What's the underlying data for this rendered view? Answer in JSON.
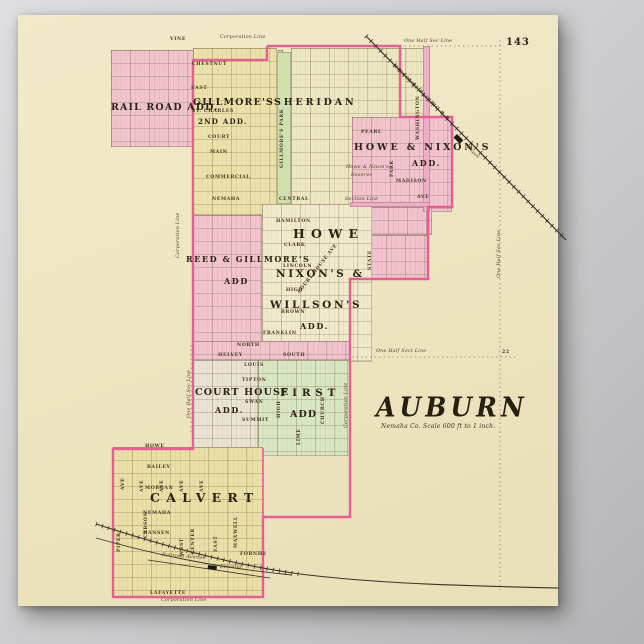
{
  "page": {
    "number": "143",
    "title": "AUBURN",
    "subtitle": "Nemaha Co. Scale 600 ft to 1 inch."
  },
  "palette": {
    "backdrop": "#c7c7c9",
    "paper": "#efe7c6",
    "addition_pink": "#f0c3cd",
    "avenue_pink": "#efaec7",
    "boundary_pink": "#e55f93",
    "addition_yellow": "#ebe2ab",
    "addition_green": "#d9e6c3",
    "park_green": "#cfe0ae",
    "addition_gray": "#e8e3d3",
    "ink": "#3a2f1e"
  },
  "map": {
    "regions": [
      {
        "id": "rail-road-add",
        "x": 111,
        "y": 50,
        "w": 172,
        "h": 97,
        "f": "#f0c3cd",
        "g": true
      },
      {
        "id": "gillmores-second-add",
        "x": 193,
        "y": 48,
        "w": 84,
        "h": 167,
        "f": "#ebe2ab",
        "g": true
      },
      {
        "id": "gillmores-park",
        "x": 277,
        "y": 52,
        "w": 14,
        "h": 152,
        "f": "#cfe0ae",
        "g": false
      },
      {
        "id": "sheridan",
        "x": 291,
        "y": 48,
        "w": 137,
        "h": 159,
        "f": "#ece6c2",
        "g": true
      },
      {
        "id": "howe-nixons-add",
        "x": 352,
        "y": 117,
        "w": 100,
        "h": 95,
        "f": "#f0c3cd",
        "g": true
      },
      {
        "id": "howe-nixons-south",
        "x": 350,
        "y": 207,
        "w": 82,
        "h": 28,
        "f": "#f0c3cd",
        "g": true
      },
      {
        "id": "state-street-blocks",
        "x": 348,
        "y": 235,
        "w": 80,
        "h": 44,
        "f": "#f0c3cd",
        "g": true
      },
      {
        "id": "center-city",
        "x": 262,
        "y": 204,
        "w": 110,
        "h": 158,
        "f": "#f0e9cb",
        "g": true
      },
      {
        "id": "reed-gillmores-add",
        "x": 193,
        "y": 215,
        "w": 69,
        "h": 146,
        "f": "#f0c3cd",
        "g": true
      },
      {
        "id": "north-street-strip",
        "x": 193,
        "y": 341,
        "w": 157,
        "h": 19,
        "f": "#f0c3cd",
        "g": true
      },
      {
        "id": "court-house-add",
        "x": 193,
        "y": 360,
        "w": 65,
        "h": 96,
        "f": "#e8e3d3",
        "g": true
      },
      {
        "id": "first-add",
        "x": 258,
        "y": 360,
        "w": 90,
        "h": 96,
        "f": "#d9e6c3",
        "g": true
      },
      {
        "id": "calvert",
        "x": 113,
        "y": 447,
        "w": 150,
        "h": 150,
        "f": "#eadfa6",
        "g": true
      },
      {
        "id": "washington-ave-stripe",
        "x": 423,
        "y": 46,
        "w": 7,
        "h": 166,
        "f": "#efaec7",
        "g": false
      },
      {
        "id": "ave-stripe",
        "x": 350,
        "y": 202,
        "w": 80,
        "h": 5,
        "f": "#efaec7",
        "g": false
      }
    ],
    "lines": [
      {
        "id": "corporation-boundary",
        "d": "M267,46 L400,46 L400,117 L452,117 L452,207 L428,207 L428,279 L350,279 L350,517 L263,517 L263,597 L113,597 L113,449 L193,449 L193,60 L267,60 L267,46",
        "s": "#e55f93",
        "w": 2.4
      },
      {
        "id": "corporation-edge-calvert",
        "d": "M263,448 L263,517",
        "s": "#e55f93",
        "w": 1.6
      },
      {
        "id": "railroad-missouri-pacific",
        "d": "M366,36 L566,240",
        "s": "#3c3326",
        "w": 1.2
      },
      {
        "id": "railroad-missouri-pacific-ties",
        "d": "M366,36 L566,240",
        "s": "#3c3326",
        "w": 5,
        "dash": "0.8 6"
      },
      {
        "id": "railroad-south-main",
        "d": "M96,524 C170,548 240,566 300,574 C380,584 470,586 558,588",
        "s": "#3c3326",
        "w": 1.1
      },
      {
        "id": "railroad-south-ties",
        "d": "M96,524 C170,548 240,566 300,574",
        "s": "#3c3326",
        "w": 4.5,
        "dash": "0.8 5.5"
      },
      {
        "id": "railroad-south-branch",
        "d": "M96,538 C160,556 220,568 292,575",
        "s": "#3c3326",
        "w": 0.9
      },
      {
        "id": "railroad-siding",
        "d": "M148,560 L270,578",
        "s": "#3c3326",
        "w": 0.8
      },
      {
        "id": "section-line-east",
        "d": "M500,40 L500,590",
        "s": "#8f8266",
        "w": 0.8,
        "dash": "1.5 3"
      },
      {
        "id": "section-line-top",
        "d": "M400,46 L500,46",
        "s": "#8f8266",
        "w": 0.8,
        "dash": "1.5 3"
      },
      {
        "id": "section-line-half",
        "d": "M352,357 L516,357",
        "s": "#8f8266",
        "w": 0.8,
        "dash": "1.5 3"
      },
      {
        "id": "section-line-west",
        "d": "M191,345 L191,434",
        "s": "#8f8266",
        "w": 0.8,
        "dash": "1.5 3"
      }
    ],
    "markers": [
      {
        "id": "depot-marker",
        "x": 457,
        "y": 134,
        "w": 9,
        "h": 5,
        "r": 45
      },
      {
        "id": "elevator-marker",
        "x": 208,
        "y": 565,
        "w": 9,
        "h": 4,
        "r": 6
      }
    ],
    "labels": [
      {
        "t": "One Half Sec Line",
        "x": 404,
        "y": 40,
        "c": "it"
      },
      {
        "t": "Corporation Line",
        "x": 220,
        "y": 36,
        "c": "it"
      },
      {
        "t": "VINE",
        "x": 170,
        "y": 38,
        "c": "st"
      },
      {
        "t": "CHESTNUT",
        "x": 192,
        "y": 63,
        "c": "st"
      },
      {
        "t": "EAST",
        "x": 191,
        "y": 87,
        "c": "st"
      },
      {
        "t": "RAIL ROAD ADD.",
        "x": 111,
        "y": 103,
        "c": "add11"
      },
      {
        "t": "GILLMORE'S",
        "x": 193,
        "y": 98,
        "c": "add11"
      },
      {
        "t": "SHERIDAN",
        "x": 274,
        "y": 98,
        "c": "add11sp"
      },
      {
        "t": "ST. CHARLES",
        "x": 192,
        "y": 110,
        "c": "st"
      },
      {
        "t": "2ND ADD.",
        "x": 198,
        "y": 118,
        "c": "add9"
      },
      {
        "t": "COURT",
        "x": 208,
        "y": 136,
        "c": "st"
      },
      {
        "t": "MAIN",
        "x": 210,
        "y": 151,
        "c": "st"
      },
      {
        "t": "COMMERCIAL",
        "x": 206,
        "y": 176,
        "c": "st"
      },
      {
        "t": "GILLMORE'S PARK",
        "x": 281,
        "y": 168,
        "c": "stv"
      },
      {
        "t": "HOWE & NIXON'S",
        "x": 354,
        "y": 143,
        "c": "add11sp"
      },
      {
        "t": "ADD.",
        "x": 412,
        "y": 159,
        "c": "add10"
      },
      {
        "t": "Howe & Nixon's",
        "x": 346,
        "y": 166,
        "c": "it"
      },
      {
        "t": "Reserve",
        "x": 351,
        "y": 174,
        "c": "it"
      },
      {
        "t": "PEARL",
        "x": 361,
        "y": 131,
        "c": "st"
      },
      {
        "t": "PARK",
        "x": 391,
        "y": 177,
        "c": "stv"
      },
      {
        "t": "MADISON",
        "x": 396,
        "y": 180,
        "c": "st"
      },
      {
        "t": "WASHINGTON",
        "x": 417,
        "y": 140,
        "c": "stv"
      },
      {
        "t": "AVE",
        "x": 417,
        "y": 196,
        "c": "st"
      },
      {
        "t": "Section Line",
        "x": 345,
        "y": 198,
        "c": "it"
      },
      {
        "t": "MISSOURI PACIFIC R R",
        "x": 394,
        "y": 64,
        "c": "rr",
        "r": 45
      },
      {
        "t": "Depot",
        "x": 468,
        "y": 146,
        "c": "it",
        "r": 45
      },
      {
        "t": "One Half Sec Line",
        "x": 498,
        "y": 278,
        "c": "itv"
      },
      {
        "t": "NEMAHA",
        "x": 212,
        "y": 198,
        "c": "st"
      },
      {
        "t": "CENTRAL",
        "x": 279,
        "y": 198,
        "c": "st"
      },
      {
        "t": "HAMILTON",
        "x": 276,
        "y": 220,
        "c": "st"
      },
      {
        "t": "HOWE",
        "x": 293,
        "y": 228,
        "c": "add14sp"
      },
      {
        "t": "CLARK",
        "x": 284,
        "y": 244,
        "c": "st"
      },
      {
        "t": "REED & GILLMORE'S",
        "x": 186,
        "y": 255,
        "c": "add10"
      },
      {
        "t": "ADD",
        "x": 224,
        "y": 277,
        "c": "add10"
      },
      {
        "t": "LINCOLN",
        "x": 283,
        "y": 265,
        "c": "st"
      },
      {
        "t": "NIXON'S &",
        "x": 276,
        "y": 269,
        "c": "add12"
      },
      {
        "t": "HIGH",
        "x": 286,
        "y": 289,
        "c": "st"
      },
      {
        "t": "WILLSON'S",
        "x": 270,
        "y": 300,
        "c": "add12"
      },
      {
        "t": "BROWN",
        "x": 281,
        "y": 311,
        "c": "st"
      },
      {
        "t": "ADD.",
        "x": 300,
        "y": 322,
        "c": "add10"
      },
      {
        "t": "FRANKLIN",
        "x": 263,
        "y": 332,
        "c": "st"
      },
      {
        "t": "STATE",
        "x": 369,
        "y": 270,
        "c": "stv"
      },
      {
        "t": "COURT HOUSE AVE",
        "x": 298,
        "y": 292,
        "c": "st",
        "r": -52
      },
      {
        "t": "Corporation Line",
        "x": 177,
        "y": 258,
        "c": "itv"
      },
      {
        "t": "One Half Sect Line",
        "x": 376,
        "y": 350,
        "c": "it"
      },
      {
        "t": "22",
        "x": 502,
        "y": 351,
        "c": "st"
      },
      {
        "t": "One Half Sec Line",
        "x": 188,
        "y": 418,
        "c": "itv"
      },
      {
        "t": "NORTH",
        "x": 237,
        "y": 344,
        "c": "st"
      },
      {
        "t": "HELVEY",
        "x": 218,
        "y": 354,
        "c": "st"
      },
      {
        "t": "LOUIS",
        "x": 244,
        "y": 364,
        "c": "st"
      },
      {
        "t": "TIPTON",
        "x": 242,
        "y": 379,
        "c": "st"
      },
      {
        "t": "COURT HOUSE",
        "x": 195,
        "y": 388,
        "c": "add11"
      },
      {
        "t": "ADD.",
        "x": 215,
        "y": 406,
        "c": "add10"
      },
      {
        "t": "SWAN",
        "x": 245,
        "y": 401,
        "c": "st"
      },
      {
        "t": "SUMMIT",
        "x": 242,
        "y": 419,
        "c": "st"
      },
      {
        "t": "SOUTH",
        "x": 283,
        "y": 354,
        "c": "st"
      },
      {
        "t": "FIRST",
        "x": 280,
        "y": 388,
        "c": "add12sp"
      },
      {
        "t": "ADD",
        "x": 290,
        "y": 410,
        "c": "add11"
      },
      {
        "t": "HIGH",
        "x": 278,
        "y": 418,
        "c": "stv"
      },
      {
        "t": "CHURCH",
        "x": 322,
        "y": 424,
        "c": "stv"
      },
      {
        "t": "LIME",
        "x": 298,
        "y": 445,
        "c": "stv"
      },
      {
        "t": "Corporation Line",
        "x": 345,
        "y": 428,
        "c": "itv"
      },
      {
        "t": "HOWE",
        "x": 145,
        "y": 445,
        "c": "st"
      },
      {
        "t": "BAILEY",
        "x": 147,
        "y": 466,
        "c": "st"
      },
      {
        "t": "AVE",
        "x": 122,
        "y": 490,
        "c": "stv"
      },
      {
        "t": "AVE",
        "x": 141,
        "y": 492,
        "c": "stv"
      },
      {
        "t": "AVE",
        "x": 161,
        "y": 492,
        "c": "stv"
      },
      {
        "t": "AVE",
        "x": 181,
        "y": 492,
        "c": "stv"
      },
      {
        "t": "AVE",
        "x": 201,
        "y": 492,
        "c": "stv"
      },
      {
        "t": "MORGAN",
        "x": 145,
        "y": 487,
        "c": "st"
      },
      {
        "t": "CALVERT",
        "x": 150,
        "y": 492,
        "c": "add14sp"
      },
      {
        "t": "NEMAHA",
        "x": 143,
        "y": 512,
        "c": "st"
      },
      {
        "t": "HANSEN",
        "x": 143,
        "y": 532,
        "c": "st"
      },
      {
        "t": "PIPER",
        "x": 118,
        "y": 552,
        "c": "stv"
      },
      {
        "t": "CARSON",
        "x": 145,
        "y": 538,
        "c": "stv"
      },
      {
        "t": "WEST",
        "x": 181,
        "y": 556,
        "c": "stv"
      },
      {
        "t": "CENTER",
        "x": 192,
        "y": 554,
        "c": "stv"
      },
      {
        "t": "EAST",
        "x": 215,
        "y": 552,
        "c": "stv"
      },
      {
        "t": "MAXWELL",
        "x": 235,
        "y": 548,
        "c": "stv"
      },
      {
        "t": "FORNHE",
        "x": 240,
        "y": 553,
        "c": "st"
      },
      {
        "t": "Railroad Avenue",
        "x": 162,
        "y": 554,
        "c": "it",
        "r": 4
      },
      {
        "t": "Elevator",
        "x": 220,
        "y": 566,
        "c": "it"
      },
      {
        "t": "LAFAYETTE",
        "x": 150,
        "y": 592,
        "c": "st"
      },
      {
        "t": "Corporation Line",
        "x": 161,
        "y": 599,
        "c": "it"
      }
    ]
  }
}
